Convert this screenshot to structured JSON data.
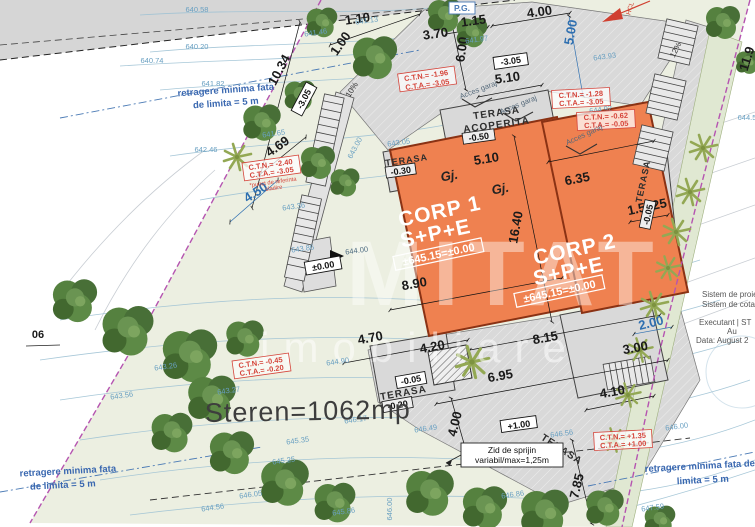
{
  "colors": {
    "building": "#ef8150",
    "building_border": "#8a3214",
    "boundary": "#b554b0",
    "paved": "#d9d9d9",
    "plot": "#ecefe1",
    "dimension_blue": "#2e6fb0",
    "elevation_blue": "#69a0c2",
    "survey_red": "#d5443a",
    "tree_green": "#4d7a3a",
    "shrub_green": "#93a854"
  },
  "watermark": {
    "line1": "MITAT",
    "line2": "imobiliare"
  },
  "area_label": "Steren=1062mp",
  "parcel_label": "06",
  "pg_label": "P.G.",
  "north_ref": "HCL",
  "buildings": [
    {
      "name": "CORP 1",
      "regime": "S+P+E",
      "level": "±645.15=±0.00"
    },
    {
      "name": "CORP 2",
      "regime": "S+P+E",
      "level": "±645.15=±0.00"
    }
  ],
  "terraces": {
    "covered": {
      "line1": "TERASA",
      "line2": "ACOPERITA",
      "level": "-0.50"
    },
    "nw": {
      "label": "TERASA",
      "level": "-0.30"
    },
    "south": {
      "label": "TERASA",
      "level": "-0.20"
    },
    "east": {
      "label": "TERASA",
      "level": "-0.05"
    },
    "se": {
      "label": "TERASA",
      "level": "+1.00"
    }
  },
  "garage_labels": [
    "Gj.",
    "Gj."
  ],
  "level_marks": {
    "garage_top": "-3.05",
    "garage_side": "-3.05",
    "entrance": "±0.00",
    "planter": "-0.05"
  },
  "dimensions": [
    "1.10",
    "1.15",
    "4.00",
    "1.00",
    "3.70",
    "10.34",
    "6.00",
    "5.00",
    "5.10",
    "4.69",
    "4.50",
    "5.10",
    "6.35",
    "1.5525",
    "16.40",
    "8.90",
    "4.70",
    "4.20",
    "8.15",
    "3.00",
    "6.95",
    "4.10",
    "2.00",
    "4.00",
    "7.85",
    "11.9"
  ],
  "slopes": [
    "10%",
    "12%"
  ],
  "access_label": "Acces garaj",
  "setback_notes": [
    {
      "line1": "retragere minima fata",
      "line2": "de limita = 5 m"
    },
    {
      "line1": "retragere minima fata",
      "line2": "de limita = 5 m"
    },
    {
      "line1": "retragere minima fata de",
      "line2": "limita = 5 m"
    }
  ],
  "survey_boxes": [
    {
      "ctn": "C.T.N.= -1.96",
      "cta": "C.T.A.= -3.05"
    },
    {
      "ctn": "C.T.N.= -1.28",
      "cta": "C.T.A.= -3.05"
    },
    {
      "ctn": "C.T.N.= -0.62",
      "cta": "C.T.A.= -0.05"
    },
    {
      "ctn": "C.T.N.= -2.40",
      "cta": "C.T.A.= -3.05",
      "note1": "*punct de referinta",
      "note2": "cladire"
    },
    {
      "ctn": "C.T.N.= -0.45",
      "cta": "C.T.A.= -0.20"
    },
    {
      "ctn": "C.T.N.= +1.35",
      "cta": "C.T.A.= +1.00"
    }
  ],
  "retaining_wall": {
    "line1": "Zid de sprijin",
    "line2": "variabil/max=1,25m"
  },
  "info_block": {
    "line1": "Sistem de proie",
    "line2": "Sistem de cota",
    "line3": "Executant | ST",
    "line4": "Au",
    "line5": "Data: August 2"
  },
  "elevations": [
    "640.58",
    "640.20",
    "640.74",
    "641.82",
    "642.46",
    "641.13",
    "641.46",
    "641.65",
    "641.97",
    "643.93",
    "644.92",
    "644.5",
    "643.05",
    "643.00",
    "643.36",
    "643.86",
    "644.00",
    "643.26",
    "643.27",
    "643.56",
    "644.56",
    "646.05",
    "646.17",
    "646.49",
    "644.90",
    "645.35",
    "645.25",
    "645.86",
    "646.00",
    "646.56",
    "647.59",
    "646.86",
    "646.00"
  ]
}
